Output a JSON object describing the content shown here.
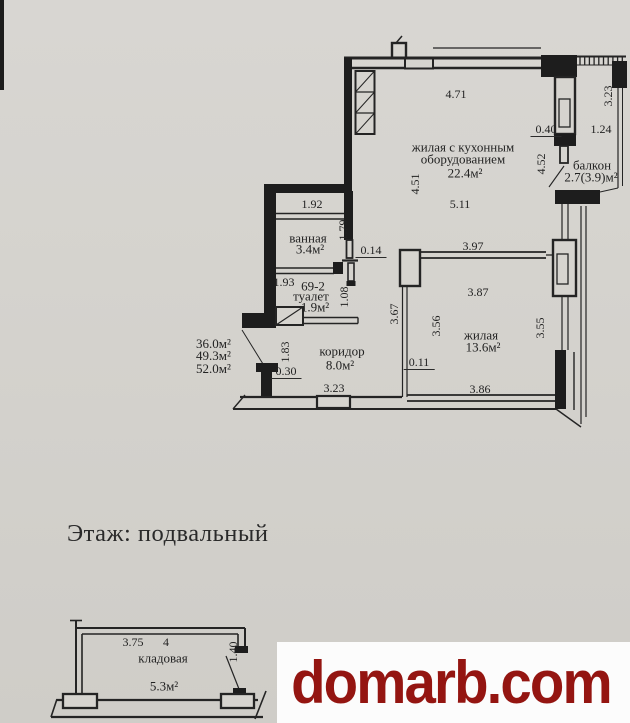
{
  "document": {
    "floor_label": "Этаж: подвальный",
    "watermark": "domarb.com"
  },
  "floor_plan": {
    "unit_number": "69-2",
    "area_summary": [
      "36.0м²",
      "49.3м²",
      "52.0м²"
    ],
    "rooms": {
      "living_kitchen": {
        "name": "жилая с кухонным оборудованием",
        "area": "22.4м²"
      },
      "balcony": {
        "name": "балкон",
        "area": "2.7(3.9)м²"
      },
      "bathroom": {
        "name": "ванная",
        "area": "3.4м²"
      },
      "toilet": {
        "name": "туалет",
        "area": "1.9м²"
      },
      "corridor": {
        "name": "коридор",
        "area": "8.0м²"
      },
      "living": {
        "name": "жилая",
        "area": "13.6м²"
      }
    },
    "dimensions": [
      "4.71",
      "3.23",
      "0.40",
      "1.24",
      "4.52",
      "4.51",
      "5.11",
      "1.92",
      "1.79",
      "0.14",
      "1.93",
      "1.08",
      "3.97",
      "3.87",
      "3.67",
      "3.56",
      "3.55",
      "1.83",
      "0.30",
      "3.23",
      "0.11",
      "3.86"
    ]
  },
  "storage_plan": {
    "room": {
      "name": "кладовая",
      "area": "5.3м²"
    },
    "storage_number": "4",
    "dimensions": [
      "3.75",
      "1.40"
    ]
  },
  "colors": {
    "watermark_red": "#941511",
    "paper": "#d5d3ce",
    "ink": "#242424"
  }
}
